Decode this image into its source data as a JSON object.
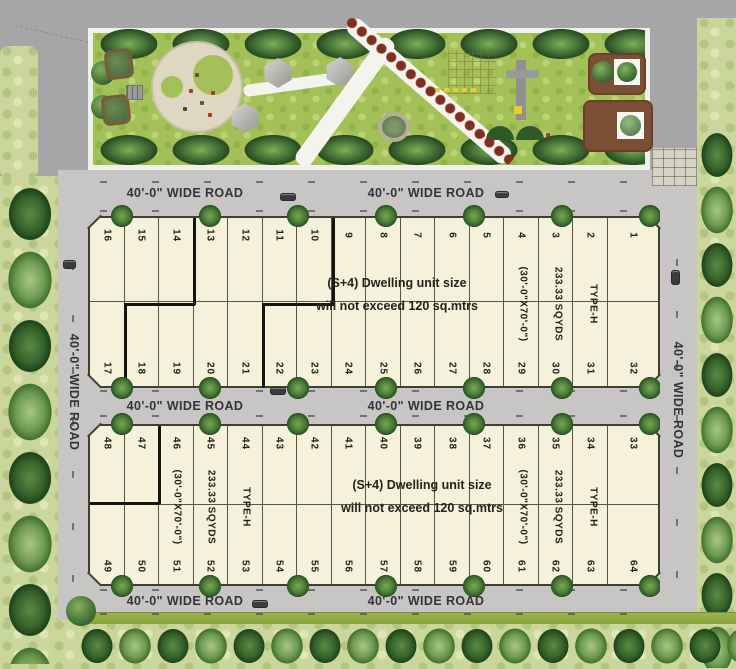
{
  "roads": {
    "wide_road_label": "40'-0\" WIDE ROAD"
  },
  "plot_labels": {
    "dimension": "(30'-0\"X70'-0\")",
    "area": "233.33 SQYDS",
    "type": "TYPE-H",
    "note_line1": "(S+4) Dwelling unit size",
    "note_line2": "will not exceed 120 sq.mtrs"
  },
  "top_block": {
    "row1": [
      "16",
      "15",
      "14",
      "13",
      "12",
      "11",
      "10",
      "9",
      "8",
      "7",
      "6",
      "5",
      "4",
      "3",
      "2",
      "1"
    ],
    "row2": [
      "17",
      "18",
      "19",
      "20",
      "21",
      "22",
      "23",
      "24",
      "25",
      "26",
      "27",
      "28",
      "29",
      "30",
      "31",
      "32"
    ]
  },
  "bottom_block": {
    "row1": [
      "48",
      "47",
      "46",
      "45",
      "44",
      "43",
      "42",
      "41",
      "40",
      "39",
      "38",
      "37",
      "36",
      "35",
      "34",
      "33"
    ],
    "row2": [
      "49",
      "50",
      "51",
      "52",
      "53",
      "54",
      "55",
      "56",
      "57",
      "58",
      "59",
      "60",
      "61",
      "62",
      "63",
      "64"
    ]
  },
  "icons": {
    "tree": "green-circle-foliage",
    "car": "dark-rounded-rect",
    "gazebo": "gray-hexagon-roof",
    "pond": "rounded-square-water",
    "fountain": "gray-cross-with-yellow",
    "planter": "brown-square-with-white-box"
  },
  "colors": {
    "road_gray": "#a6a6a8",
    "inner_road_gray": "#c7c6c4",
    "grass_green": "#cbd69c",
    "park_green": "#a3c158",
    "plot_cream": "#f6f1da",
    "tree_dark_green": "#35622b",
    "shrub_red": "#7e2f1f",
    "line_color": "#56564c"
  }
}
